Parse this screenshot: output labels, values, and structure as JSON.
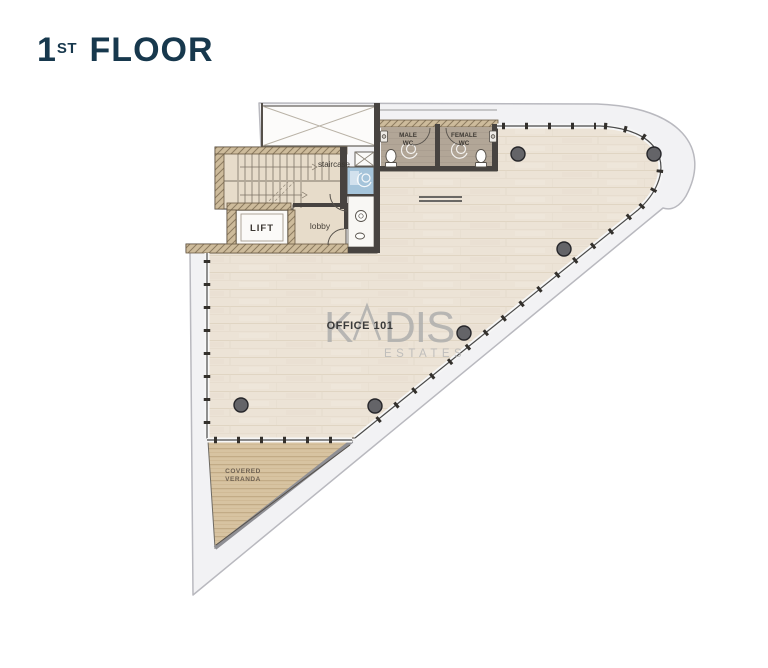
{
  "header": {
    "title_number": "1",
    "title_suffix": "ST",
    "title_word": " FLOOR",
    "title_color": "#17384d"
  },
  "floorplan": {
    "office_label": "OFFICE 101",
    "watermark": {
      "part1": "K",
      "part2": "DIS",
      "sub": "ESTATES"
    },
    "rooms": {
      "staircase": "staircase",
      "lift": "LIFT",
      "lobby": "lobby",
      "male_wc_line1": "MALE",
      "male_wc_line2": "WC",
      "female_wc_line1": "FEMALE",
      "female_wc_line2": "WC",
      "veranda_line1": "COVERED",
      "veranda_line2": "VERANDA"
    },
    "colors": {
      "slab_band": "#f2f2f4",
      "slab_edge": "#b9b9bf",
      "office_floor": "#ece3d6",
      "core_floor": "#e7dcca",
      "wc_floor": "#b2a697",
      "accessible_wc_floor": "#a5c4da",
      "veranda_floor": "#d7c3a1",
      "wall_dark": "#474340",
      "wall_hatch": "#cdbb9b",
      "column": "#646468",
      "watermark_gray": "#ababab",
      "label_dark": "#3c3833"
    }
  }
}
